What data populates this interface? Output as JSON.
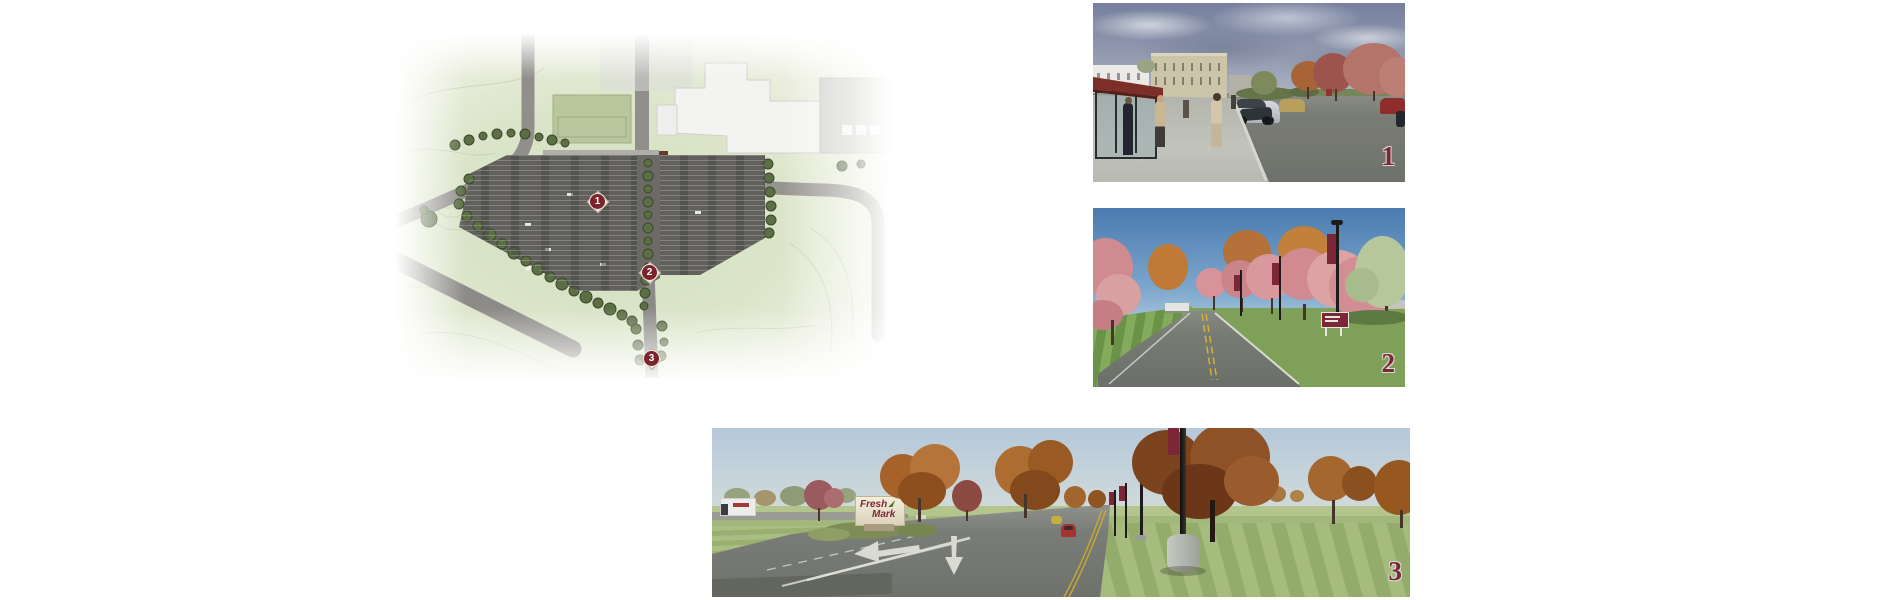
{
  "site_plan": {
    "markers": [
      {
        "label": "1"
      },
      {
        "label": "2"
      },
      {
        "label": "3"
      }
    ]
  },
  "renders": [
    {
      "number": "1"
    },
    {
      "number": "2"
    },
    {
      "number": "3",
      "sign": {
        "line1": "Fresh",
        "line2": "Mark"
      }
    }
  ],
  "colors": {
    "marker_maroon": "#7a2430",
    "numeral_maroon": "#7c2737",
    "banner_maroon": "#7c2737",
    "plan_green": "#dbe3c8",
    "asphalt_gray": "#6e716c",
    "sign_leaf_green": "#4a7a2a"
  }
}
